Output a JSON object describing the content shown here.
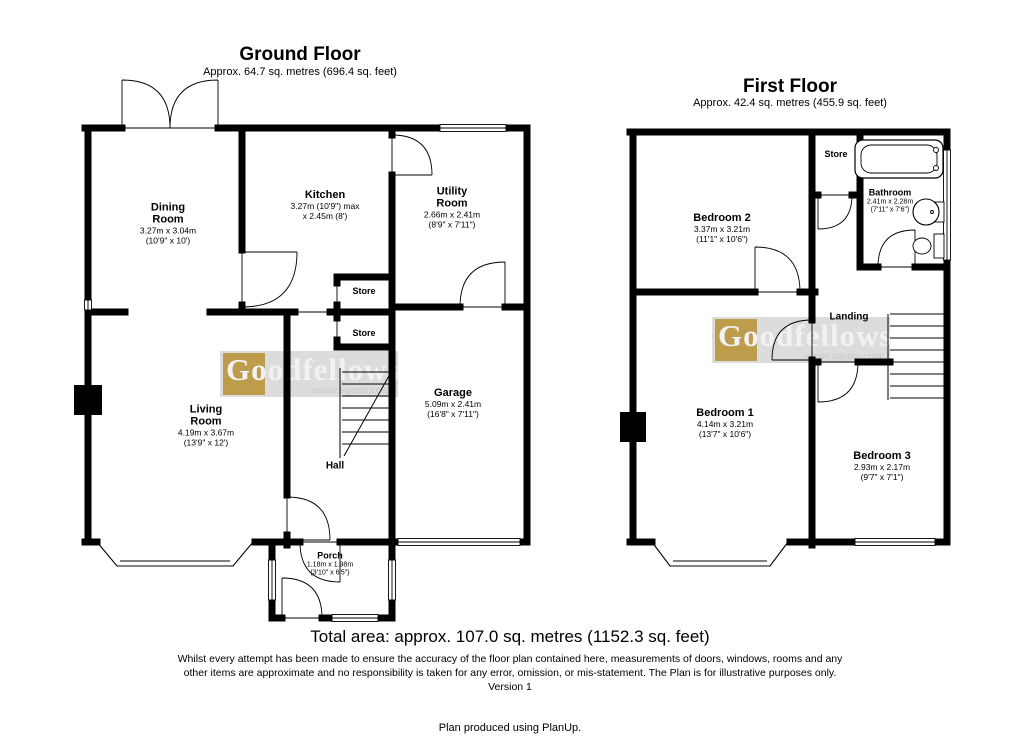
{
  "ground_floor": {
    "title": "Ground Floor",
    "subtitle": "Approx. 64.7 sq. metres (696.4 sq. feet)",
    "rooms": [
      {
        "name": "Dining\nRoom",
        "dims_m": "3.27m x 3.04m",
        "dims_ft": "(10'9\" x 10')"
      },
      {
        "name": "Kitchen",
        "dims_m": "3.27m (10'9\") max",
        "dims_ft": "x 2.45m (8')"
      },
      {
        "name": "Utility\nRoom",
        "dims_m": "2.66m x 2.41m",
        "dims_ft": "(8'9\" x 7'11\")"
      },
      {
        "name": "Store"
      },
      {
        "name": "Store"
      },
      {
        "name": "Living\nRoom",
        "dims_m": "4.19m x 3.67m",
        "dims_ft": "(13'9\" x 12')"
      },
      {
        "name": "Garage",
        "dims_m": "5.09m x 2.41m",
        "dims_ft": "(16'8\" x 7'11\")"
      },
      {
        "name": "Hall"
      },
      {
        "name": "Porch",
        "dims_m": "1.18m x 1.98m",
        "dims_ft": "(3'10\" x 6'5\")"
      }
    ]
  },
  "first_floor": {
    "title": "First Floor",
    "subtitle": "Approx. 42.4 sq. metres (455.9 sq. feet)",
    "rooms": [
      {
        "name": "Bedroom 2",
        "dims_m": "3.37m x 3.21m",
        "dims_ft": "(11'1\" x 10'6\")"
      },
      {
        "name": "Store"
      },
      {
        "name": "Bathroom",
        "dims_m": "2.41m x 2.28m",
        "dims_ft": "(7'11\" x 7'6\")"
      },
      {
        "name": "Landing"
      },
      {
        "name": "Bedroom 1",
        "dims_m": "4.14m x 3.21m",
        "dims_ft": "(13'7\" x 10'6\")"
      },
      {
        "name": "Bedroom 3",
        "dims_m": "2.93m x 2.17m",
        "dims_ft": "(9'7\" x 7'1\")"
      }
    ]
  },
  "summary": {
    "total_area": "Total area: approx. 107.0 sq. metres (1152.3 sq. feet)",
    "disclaimer": "Whilst every attempt has been made to ensure the accuracy of the floor plan contained here, measurements of doors, windows, rooms and any other items are approximate and no responsibility is taken for any error, omission, or mis-statement. The Plan is for illustrative purposes only.",
    "version": "Version 1",
    "footer": "Plan produced using PlanUp."
  },
  "watermark": {
    "brand": "Goodfellows",
    "tagline": "estate agents.com",
    "gold_color": "#bd9c4b",
    "band_color": "#dcdcdc"
  }
}
